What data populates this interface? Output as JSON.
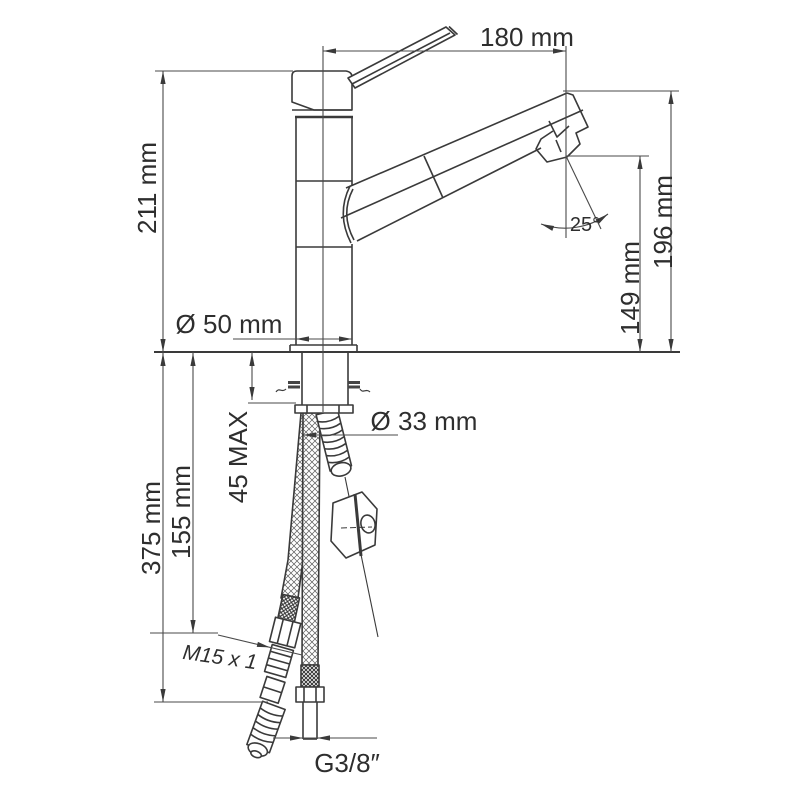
{
  "diagram": {
    "type": "technical-drawing",
    "subject": "single-lever kitchen mixer tap installation dimensions",
    "units": "mm",
    "colors": {
      "line": "#3a3a3a",
      "dimension_line": "#4a4a4a",
      "text": "#2e2e2e",
      "background": "#ffffff"
    },
    "dims": {
      "spout_reach": "180 mm",
      "body_height": "211 mm",
      "spout_top_height": "196 mm",
      "aerator_height": "149 mm",
      "spout_angle": "25°",
      "base_diameter": "Ø 50 mm",
      "hole_diameter": "Ø 33 mm",
      "counter_thickness_max": "45 MAX",
      "hose_length_short": "155 mm",
      "hose_length_long": "375 mm",
      "thread_pullout_hose": "M15 x 1",
      "thread_supply_hose": "G3/8″"
    }
  }
}
